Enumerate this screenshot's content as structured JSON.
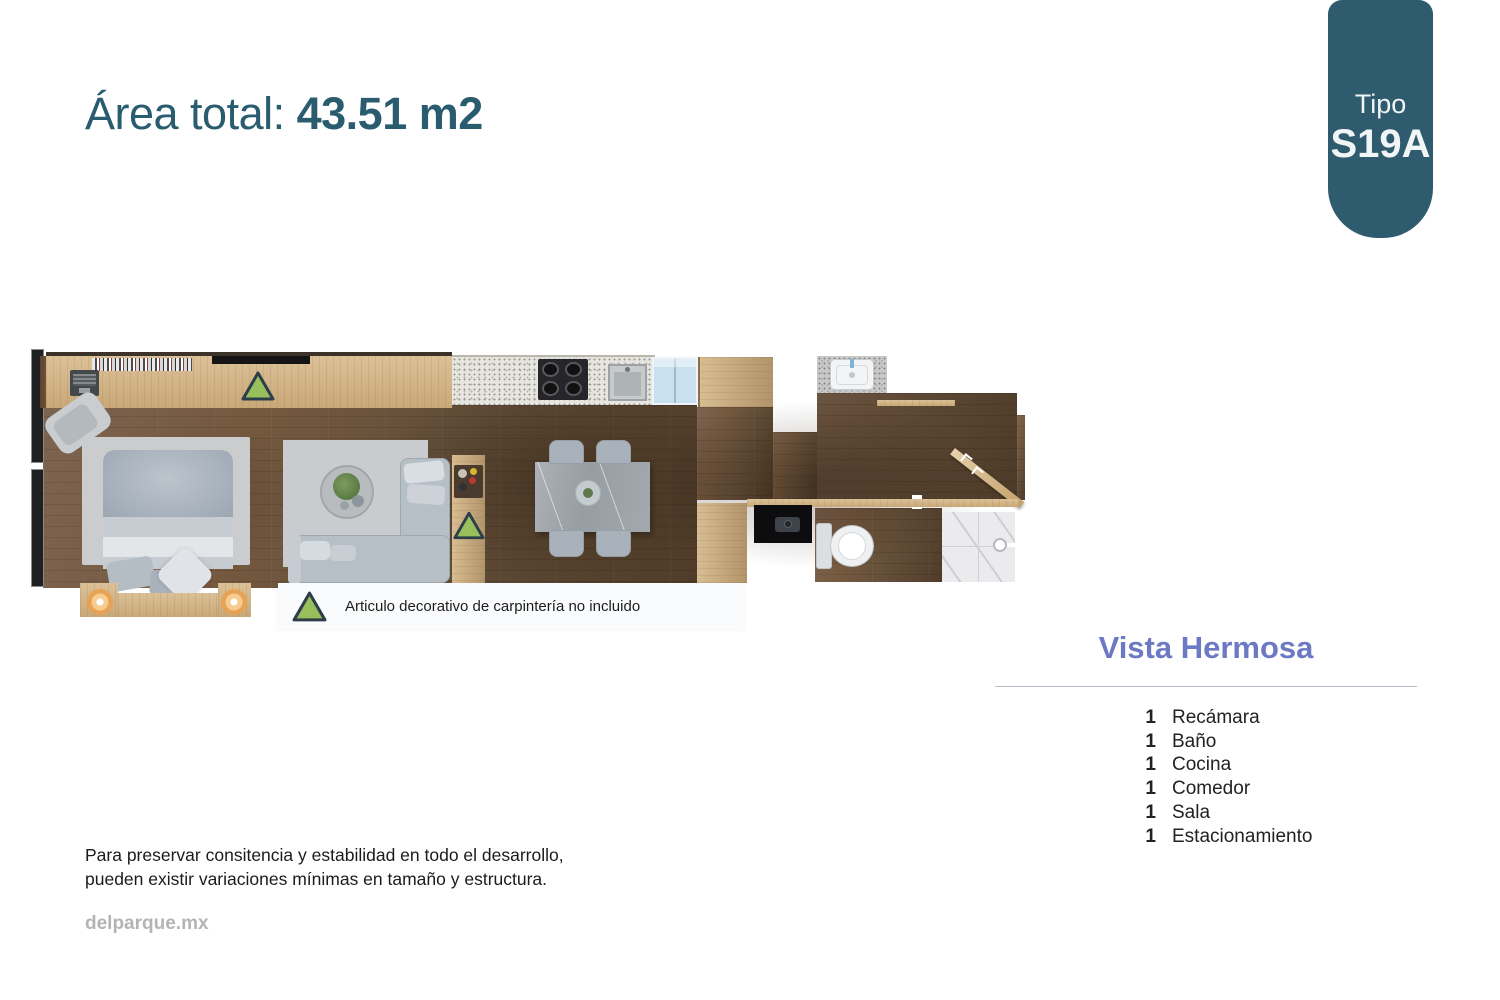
{
  "header": {
    "area_label": "Área total: ",
    "area_value": "43.51 m2"
  },
  "badge": {
    "label": "Tipo",
    "code": "S19A"
  },
  "floorplan": {
    "legend_text": "Articulo decorativo de carpintería no incluido",
    "legend_marker": "green-triangle"
  },
  "unit": {
    "name": "Vista Hermosa",
    "features": [
      {
        "count": "1",
        "label": "Recámara"
      },
      {
        "count": "1",
        "label": "Baño"
      },
      {
        "count": "1",
        "label": "Cocina"
      },
      {
        "count": "1",
        "label": "Comedor"
      },
      {
        "count": "1",
        "label": "Sala"
      },
      {
        "count": "1",
        "label": "Estacionamiento"
      }
    ]
  },
  "footer": {
    "disclaimer_line1": "Para preservar consitencia y estabilidad en todo el desarrollo,",
    "disclaimer_line2": "pueden existir variaciones mínimas en tamaño y estructura.",
    "website": "delparque.mx"
  },
  "colors": {
    "accent_teal": "#2e5c6e",
    "heading_purple": "#6d79c3",
    "marker_green": "#97c05c",
    "marker_border": "#2e3d4a"
  }
}
